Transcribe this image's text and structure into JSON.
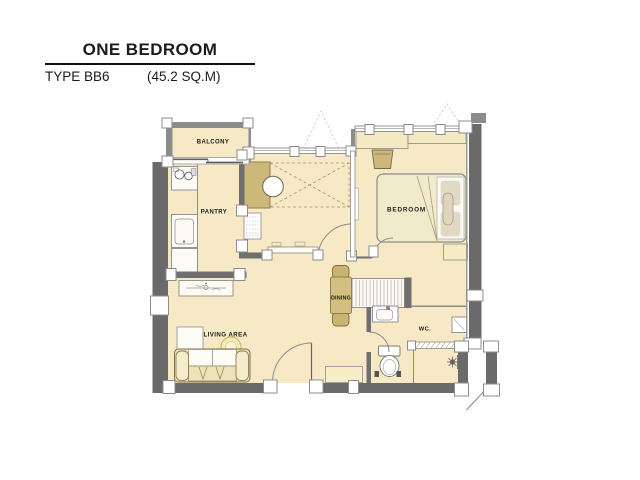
{
  "header": {
    "title": "ONE BEDROOM",
    "type_label": "TYPE BB6",
    "area_label": "(45.2 SQ.M)"
  },
  "rooms": {
    "balcony": "BALCONY",
    "pantry": "PANTRY",
    "bedroom": "BEDROOM",
    "dining": "DINING",
    "living": "LIVING AREA",
    "wc": "WC."
  },
  "palette": {
    "paper": "#ffffff",
    "room_fill": "#f7e9c5",
    "wall_dark": "#6a6a6a",
    "wall_medium": "#8c8c8c",
    "wall_interior": "#6f6f6f",
    "furn_tan": "#d3bf7f",
    "counter_tan": "#cdb87a",
    "outline_tan": "#8f7d4a",
    "ink": "#1c1c1c"
  }
}
